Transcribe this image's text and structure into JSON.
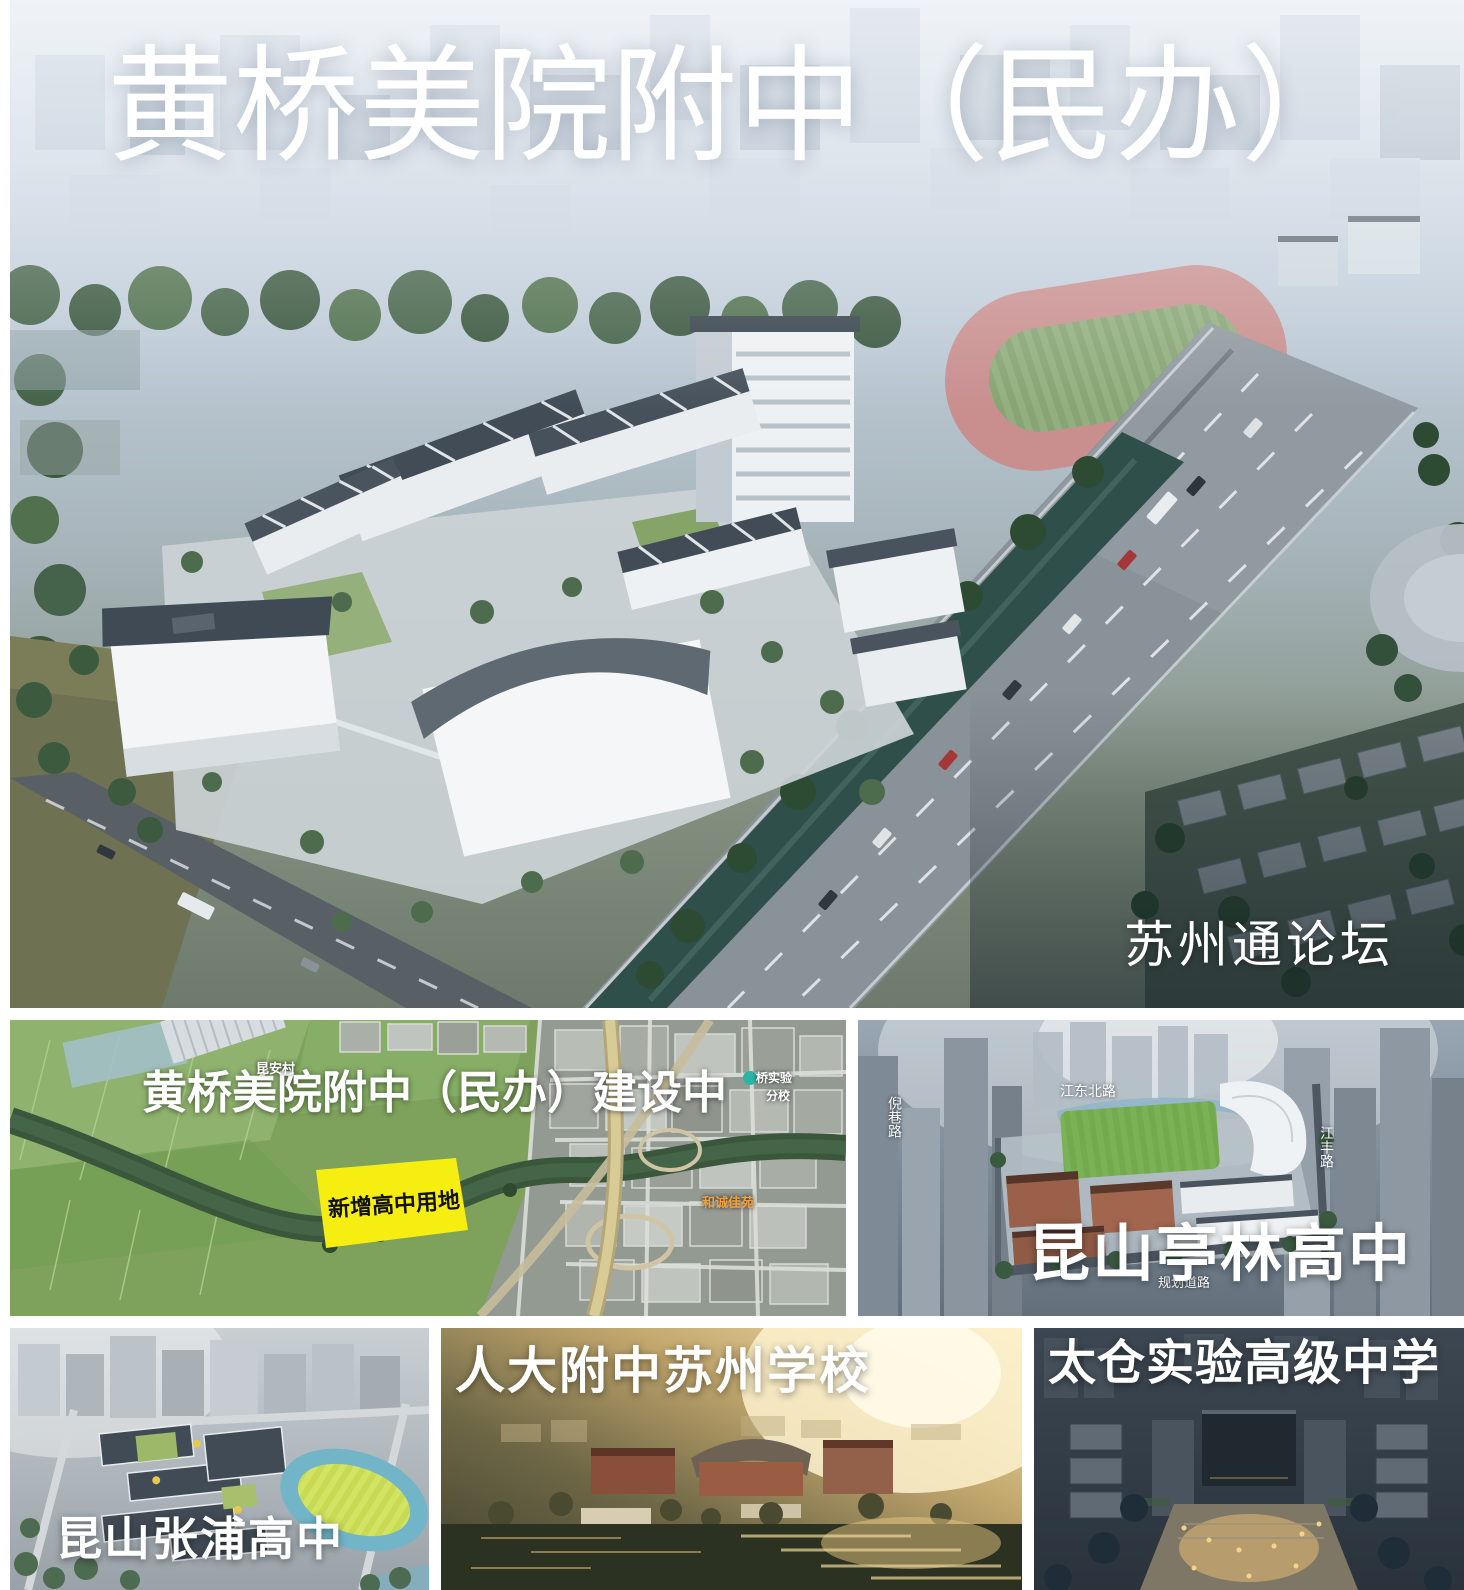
{
  "collage": {
    "main": {
      "title": "黄桥美院附中（民办）",
      "watermark": "苏州通论坛"
    },
    "map": {
      "caption": "黄桥美院附中（民办）建设中",
      "site_label": "新增高中用地",
      "site_color": "#f7ee11",
      "village_label": "昆安村",
      "poi_school_line1": "桥实验",
      "poi_school_line2": "分校",
      "estate_label": "和诚佳苑"
    },
    "tinglin": {
      "title": "昆山亭林高中",
      "road_top": "江东北路",
      "road_left": "倪巷路",
      "road_right": "江丰路",
      "road_bottom": "规划道路"
    },
    "zhangpu": {
      "title": "昆山张浦高中"
    },
    "renda": {
      "title": "人大附中苏州学校"
    },
    "taicang": {
      "title": "太仓实验高级中学"
    }
  }
}
